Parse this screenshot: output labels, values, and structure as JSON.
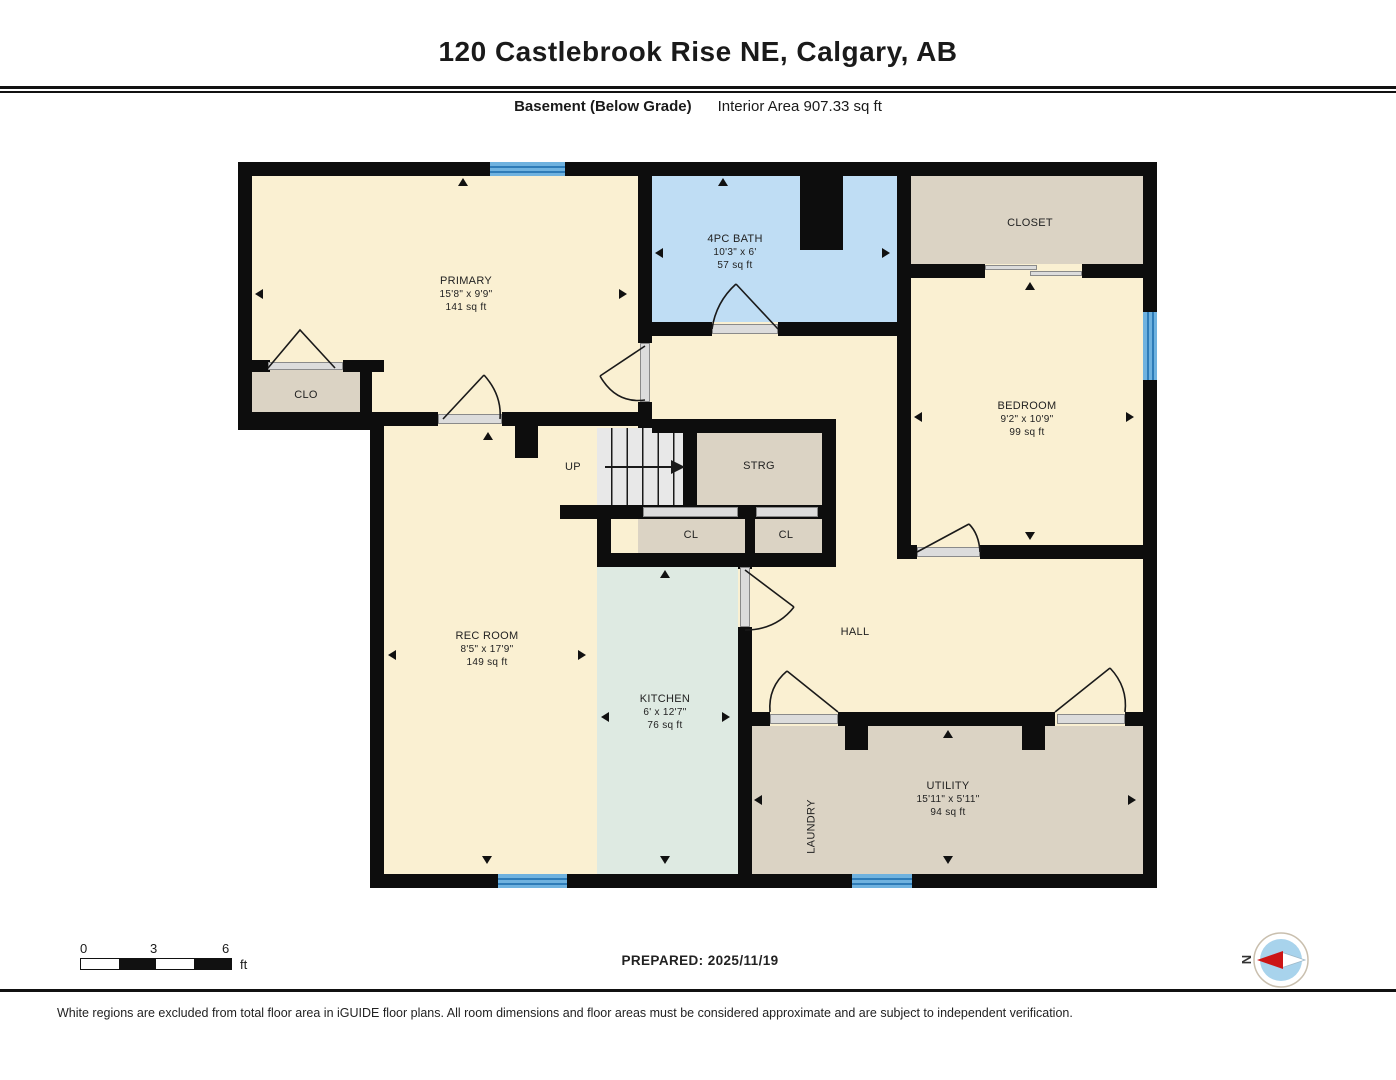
{
  "header": {
    "title": "120 Castlebrook Rise NE, Calgary, AB",
    "floor_label": "Basement (Below Grade)",
    "area_label": "Interior Area 907.33 sq ft"
  },
  "plan": {
    "rooms": {
      "primary": {
        "name": "PRIMARY",
        "dims": "15'8\" x 9'9\"",
        "area": "141 sq ft"
      },
      "bath": {
        "name": "4PC BATH",
        "dims": "10'3\" x 6'",
        "area": "57 sq ft"
      },
      "closet": {
        "name": "CLOSET"
      },
      "bedroom": {
        "name": "BEDROOM",
        "dims": "9'2\" x 10'9\"",
        "area": "99 sq ft"
      },
      "clo": {
        "name": "CLO"
      },
      "strg": {
        "name": "STRG"
      },
      "cl_left": {
        "name": "CL"
      },
      "cl_right": {
        "name": "CL"
      },
      "rec_room": {
        "name": "REC ROOM",
        "dims": "8'5\" x 17'9\"",
        "area": "149 sq ft"
      },
      "kitchen": {
        "name": "KITCHEN",
        "dims": "6' x 12'7\"",
        "area": "76 sq ft"
      },
      "hall": {
        "name": "HALL"
      },
      "laundry": {
        "name": "LAUNDRY"
      },
      "utility": {
        "name": "UTILITY",
        "dims": "15'11\" x 5'11\"",
        "area": "94 sq ft"
      }
    },
    "stairs_label": "UP"
  },
  "footer": {
    "scale": {
      "tick0": "0",
      "tick1": "3",
      "tick2": "6",
      "unit": "ft"
    },
    "prepared": "PREPARED: 2025/11/19",
    "compass": "N",
    "disclaimer": "White regions are excluded from total floor area in iGUIDE floor plans. All room dimensions and floor areas must be considered approximate and are subject to independent verification."
  },
  "colors": {
    "wall": "#0d0d0d",
    "room_cream": "#FAF0D2",
    "room_tan": "#DBD3C4",
    "room_blue": "#BFDDF4",
    "room_mint": "#DEEAE2",
    "stairs_gray": "#E8E8E8",
    "window_blue": "#6FB2DF",
    "window_stripe": "#2E7CB8",
    "door_gray": "#DCDCDC",
    "compass_red": "#CC1515",
    "compass_blue": "#A8D3EC"
  }
}
